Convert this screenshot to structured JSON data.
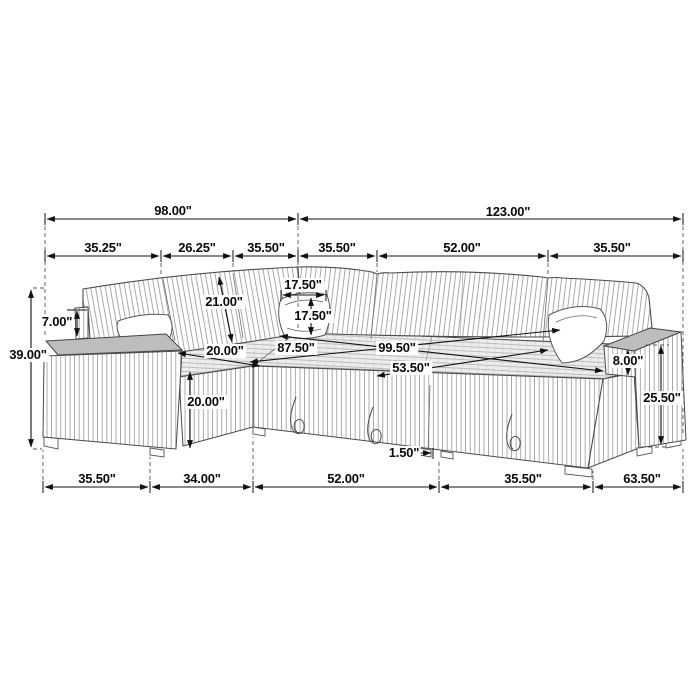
{
  "figure": {
    "subject": "U-shaped sectional sleeper sofa dimension drawing",
    "units": "inches",
    "style": "black line art on white with corduroy stripe texture"
  },
  "colors": {
    "background": "#ffffff",
    "line": "#1a1a1a",
    "fabric_stripe": "#8f8f8f",
    "top_shade": "#bdbdbd",
    "deck_fill": "#eeeeee"
  },
  "dims": {
    "top1": [
      "98.00\"",
      "123.00\""
    ],
    "top2": [
      "35.25\"",
      "26.25\"",
      "35.50\"",
      "35.50\"",
      "52.00\"",
      "35.50\""
    ],
    "bottom": [
      "35.50\"",
      "34.00\"",
      "52.00\"",
      "35.50\"",
      "63.50\""
    ],
    "left_height": "39.00\"",
    "back_ledge": "7.00\"",
    "backrest": "21.00\"",
    "pillow_width": "17.50\"",
    "pillow_height": "17.50\"",
    "seat_width": "20.00\"",
    "chaise_height": "20.00\"",
    "diag_mid": "87.50\"",
    "diag_long": "99.50\"",
    "diag_short": "53.50\"",
    "armrest_height": "8.00\"",
    "side_height": "25.50\"",
    "gap": "1.50\""
  }
}
